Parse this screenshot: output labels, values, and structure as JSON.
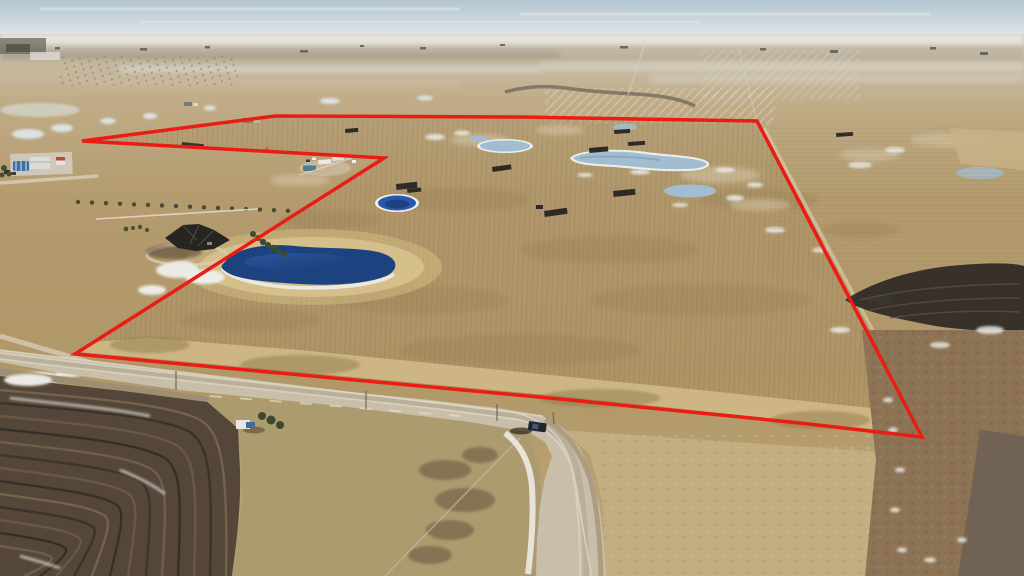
{
  "scene": {
    "description": "Oblique aerial drone photo of flat winter prairie farmland with a red outlined land parcel, gravel road, sloughs and acreage homes in the foreground",
    "season": "winter",
    "view": "oblique-aerial"
  },
  "boundary": {
    "color": "#ea1c14",
    "stroke_width": 3.5,
    "points": "82,141 275,116 520,117 757,121 922,437 800,423 560,399 75,354 384,158"
  },
  "features": {
    "sky": {
      "top_color": "#b3c5d2",
      "horizon_color": "#e3e8e9"
    },
    "large_pond": {
      "label": "large deep-blue slough",
      "color": "#1d4280"
    },
    "royal_pond": {
      "label": "small royal-blue slough",
      "color": "#2a57ad"
    },
    "pale_pond": {
      "label": "frozen pale sloughs",
      "color": "#a2bdcf"
    },
    "road": {
      "label": "gravel road",
      "surface_color": "#c8beaa"
    },
    "truck": {
      "label": "dark pickup truck",
      "color": "#1d2732"
    },
    "house": {
      "label": "acreage house",
      "roof_color": "#262522"
    },
    "farmstead": {
      "label": "farmyard with blue quonset",
      "quonset_color": "#3a6ea8"
    },
    "plowed_field": {
      "label": "dark tilled field",
      "color": "#54473a"
    },
    "burned_strip": {
      "label": "burned black strip",
      "color": "#2f2b26"
    },
    "bale_stacks": {
      "label": "dark bale stacks",
      "color": "#2e2b26",
      "count": 11
    }
  }
}
